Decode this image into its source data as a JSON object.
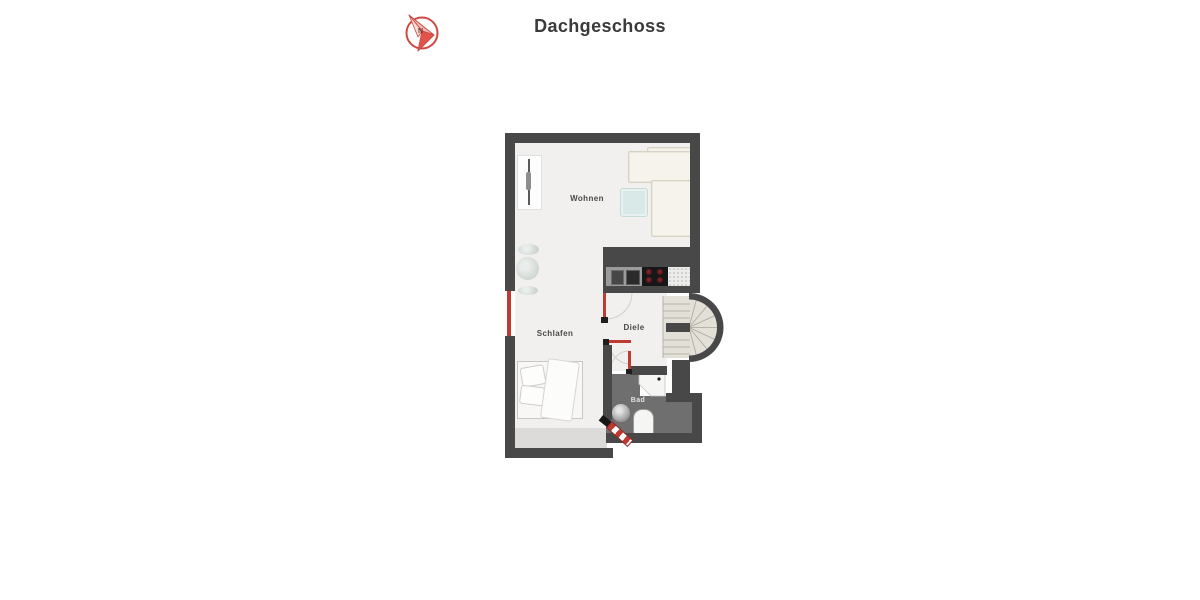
{
  "page": {
    "title": "Dachgeschoss"
  },
  "header": {
    "compass": {
      "icon": "north-arrow-compass-icon",
      "letter": "N"
    }
  },
  "rooms": {
    "wohnen": {
      "label": "Wohnen"
    },
    "schlafen": {
      "label": "Schlafen"
    },
    "diele": {
      "label": "Diele"
    },
    "bad": {
      "label": "Bad"
    }
  },
  "colors": {
    "wall": "#484848",
    "accent_red": "#bf3a32",
    "floor": "#f1f0ee",
    "floor_shaded": "#dcdbd9",
    "bath_floor": "#6f6f6f",
    "stair_tread": "#e3e0d8",
    "sofa": "#f5f3ec",
    "table": "#d9e9e8",
    "title": "#3a3a3a",
    "stove": "#171717",
    "burner": "#6b1d23",
    "sink_unit": "#9b9b9b",
    "counter": "#ececea"
  }
}
